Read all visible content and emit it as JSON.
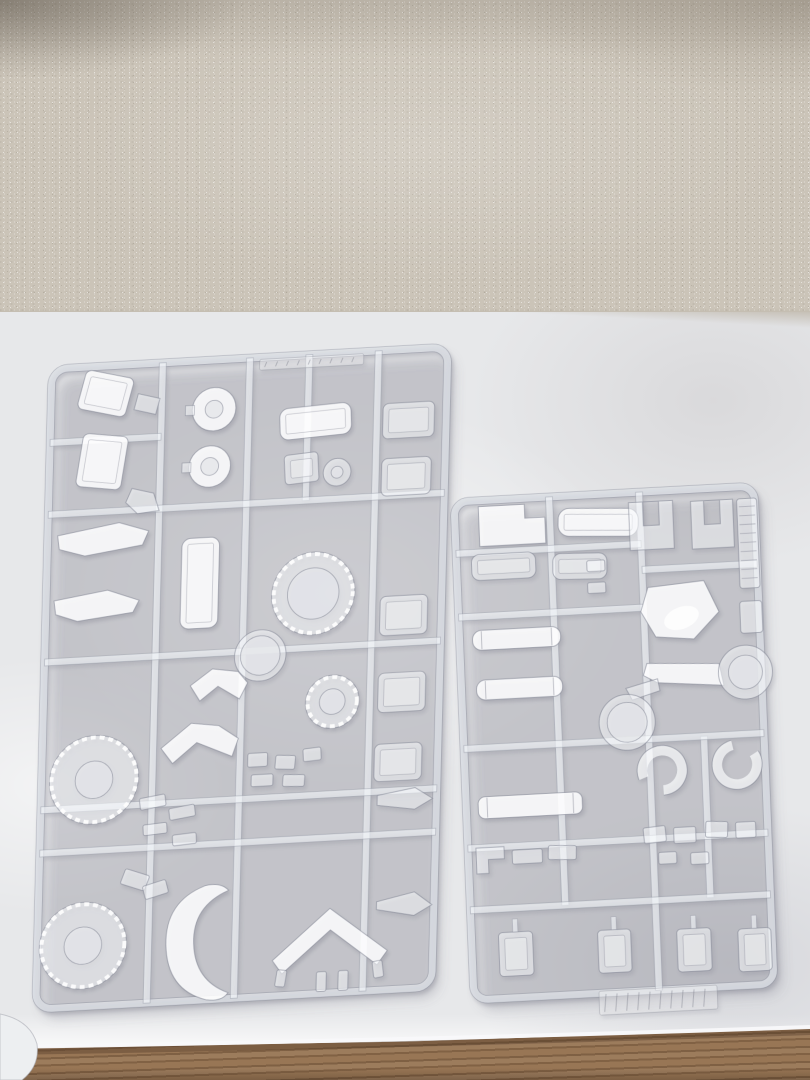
{
  "photo": {
    "width": 810,
    "height": 1080
  },
  "scene": {
    "colors": {
      "wallpaper": "#cbc4b8",
      "cloth": "#e7e8ea",
      "wood": "#916f4f",
      "plastic_fill": "rgba(252,253,255,0.55)",
      "plastic_bright": "rgba(255,255,255,0.88)",
      "plastic_outline": "rgba(128,131,146,0.55)",
      "rail_fill": "rgba(246,248,251,0.62)",
      "hole_fill": "rgba(229,230,234,0.8)"
    },
    "objects": [
      "wallpaper",
      "cloth-covered-table",
      "clear-sprue-left",
      "clear-sprue-right",
      "wood-table-edge",
      "cloth-fold"
    ]
  },
  "sprues": {
    "left": {
      "name": "clear-sprue-left",
      "matrix": [
        0.99,
        -0.055,
        -0.025,
        0.985,
        52,
        369
      ],
      "frame": [
        0,
        0,
        400,
        650,
        16
      ],
      "rails": {
        "v": [
          [
            112,
            0,
            650
          ],
          [
            200,
            0,
            650
          ],
          [
            330,
            0,
            650
          ],
          [
            260,
            0,
            148
          ]
        ],
        "h": [
          [
            148,
            0,
            400
          ],
          [
            298,
            0,
            400
          ],
          [
            448,
            0,
            400
          ],
          [
            492,
            0,
            400
          ],
          [
            75,
            0,
            112
          ]
        ]
      },
      "parts": [
        {
          "n": "armor-box",
          "t": "rect",
          "x": 30,
          "y": 8,
          "w": 50,
          "h": 40,
          "rx": 6,
          "rot": 14,
          "inner": 1,
          "bright": 1
        },
        {
          "n": "armor-box",
          "t": "rect",
          "x": 30,
          "y": 70,
          "w": 46,
          "h": 54,
          "rx": 6,
          "rot": 8,
          "inner": 1,
          "bright": 1
        },
        {
          "n": "small-wedge",
          "t": "poly",
          "pts": "88,30 110,36 106,52 84,46"
        },
        {
          "n": "small-foot",
          "t": "poly",
          "pts": "84,126 106,132 112,150 90,152 78,140"
        },
        {
          "n": "rimmed-disc",
          "t": "disc",
          "cx": 165,
          "cy": 50,
          "ro": 22,
          "ri": 9
        },
        {
          "n": "rimmed-disc",
          "t": "disc",
          "cx": 162,
          "cy": 108,
          "ro": 21,
          "ri": 9
        },
        {
          "n": "cockpit-block",
          "t": "rect",
          "x": 232,
          "y": 52,
          "w": 72,
          "h": 32,
          "rx": 9,
          "rot": -3,
          "inner": 1,
          "bright": 1
        },
        {
          "n": "bracket",
          "t": "rect",
          "x": 238,
          "y": 100,
          "w": 34,
          "h": 30,
          "rx": 4,
          "rot": -4,
          "inner": 1
        },
        {
          "n": "washer",
          "t": "ring",
          "cx": 291,
          "cy": 121,
          "ro": 14,
          "ri": 6
        },
        {
          "n": "panel",
          "t": "rect",
          "x": 336,
          "y": 54,
          "w": 52,
          "h": 36,
          "rx": 6,
          "inner": 1
        },
        {
          "n": "panel",
          "t": "rect",
          "x": 336,
          "y": 110,
          "w": 50,
          "h": 38,
          "rx": 6,
          "inner": 1
        },
        {
          "n": "panel",
          "t": "rect",
          "x": 338,
          "y": 250,
          "w": 48,
          "h": 40,
          "rx": 6,
          "inner": 1
        },
        {
          "n": "panel",
          "t": "rect",
          "x": 338,
          "y": 328,
          "w": 48,
          "h": 40,
          "rx": 6,
          "inner": 1
        },
        {
          "n": "panel",
          "t": "rect",
          "x": 336,
          "y": 400,
          "w": 48,
          "h": 38,
          "rx": 6,
          "inner": 1
        },
        {
          "n": "tray",
          "t": "rect",
          "x": 136,
          "y": 180,
          "w": 38,
          "h": 92,
          "rx": 9,
          "inner": 1,
          "bright": 1
        },
        {
          "n": "blade",
          "t": "poly",
          "pts": "10,170 72,160 102,170 96,184 38,192 12,184",
          "bright": 1
        },
        {
          "n": "blade",
          "t": "poly",
          "pts": "8,236 62,228 94,240 88,252 32,258 10,250",
          "bright": 1
        },
        {
          "n": "toothed-ring",
          "t": "ring",
          "cx": 270,
          "cy": 243,
          "ro": 42,
          "ri": 26,
          "teeth": 1
        },
        {
          "n": "ring",
          "t": "ring",
          "cx": 218,
          "cy": 303,
          "ro": 26,
          "ri": 20
        },
        {
          "n": "toothed-ring",
          "t": "ring",
          "cx": 292,
          "cy": 354,
          "ro": 27,
          "ri": 13,
          "teeth": 1
        },
        {
          "n": "curved-armor",
          "t": "poly",
          "pts": "148,330 170,314 196,318 206,330 198,346 176,332 158,346",
          "bright": 1
        },
        {
          "n": "curved-armor",
          "t": "poly",
          "pts": "120,392 150,368 178,372 198,386 192,404 156,388 132,408",
          "bright": 1
        },
        {
          "n": "toothed-donut",
          "t": "ring",
          "cx": 53,
          "cy": 420,
          "ro": 45,
          "ri": 19,
          "teeth": 1
        },
        {
          "n": "joint-bit",
          "t": "rect",
          "x": 100,
          "y": 440,
          "w": 26,
          "h": 12,
          "rot": -8
        },
        {
          "n": "joint-bit",
          "t": "rect",
          "x": 130,
          "y": 452,
          "w": 26,
          "h": 12,
          "rot": -8
        },
        {
          "n": "joint-bit",
          "t": "rect",
          "x": 104,
          "y": 468,
          "w": 24,
          "h": 11,
          "rot": -4
        },
        {
          "n": "joint-bit",
          "t": "rect",
          "x": 134,
          "y": 480,
          "w": 24,
          "h": 11,
          "rot": -4
        },
        {
          "n": "bracket-bit",
          "t": "rect",
          "x": 208,
          "y": 402,
          "w": 20,
          "h": 14
        },
        {
          "n": "bracket-bit",
          "t": "rect",
          "x": 236,
          "y": 406,
          "w": 20,
          "h": 14,
          "rot": 4
        },
        {
          "n": "bracket-bit",
          "t": "rect",
          "x": 264,
          "y": 400,
          "w": 18,
          "h": 13,
          "rot": -4
        },
        {
          "n": "bracket-bit",
          "t": "rect",
          "x": 212,
          "y": 424,
          "w": 22,
          "h": 12
        },
        {
          "n": "bracket-bit",
          "t": "rect",
          "x": 244,
          "y": 426,
          "w": 22,
          "h": 12,
          "rot": 3
        },
        {
          "n": "dart",
          "t": "poly",
          "pts": "340,452 378,446 396,458 378,468 340,462"
        },
        {
          "n": "dart",
          "t": "poly",
          "pts": "342,560 380,552 398,566 380,576 342,568"
        },
        {
          "n": "toothed-donut",
          "t": "ring",
          "cx": 46,
          "cy": 588,
          "ro": 44,
          "ri": 19,
          "teeth": 1
        },
        {
          "n": "joint-cluster",
          "t": "rect",
          "x": 84,
          "y": 516,
          "w": 26,
          "h": 16,
          "rot": 20
        },
        {
          "n": "joint-cluster",
          "t": "rect",
          "x": 106,
          "y": 528,
          "w": 24,
          "h": 14,
          "rot": -15
        },
        {
          "n": "shell",
          "t": "path",
          "d": "M168,534 Q128,548 130,592 Q132,638 172,650 Q188,653 194,644 Q160,630 158,592 Q156,554 192,540 Q184,531 168,534 Z",
          "bright": 1
        },
        {
          "n": "v-fin",
          "t": "poly",
          "pts": "295,564 354,610 344,624 296,586 248,628 238,614",
          "bright": 1
        },
        {
          "n": "v-fin-tip",
          "t": "rect",
          "x": 242,
          "y": 624,
          "w": 10,
          "h": 17,
          "rot": 8
        },
        {
          "n": "v-fin-tip",
          "t": "rect",
          "x": 340,
          "y": 620,
          "w": 10,
          "h": 17,
          "rot": -8
        },
        {
          "n": "stub-bit",
          "t": "rect",
          "x": 283,
          "y": 628,
          "w": 10,
          "h": 20
        },
        {
          "n": "stub-bit",
          "t": "rect",
          "x": 305,
          "y": 628,
          "w": 10,
          "h": 20
        },
        {
          "n": "emboss-strip",
          "t": "emboss",
          "x": 210,
          "y": 2,
          "w": 105,
          "h": 11
        }
      ]
    },
    "right": {
      "name": "clear-sprue-right",
      "matrix": [
        1,
        -0.0533,
        0.04,
        0.996,
        454,
        502
      ],
      "frame": [
        0,
        0,
        300,
        500,
        14
      ],
      "rails": {
        "v": [
          [
            95,
            0,
            410
          ],
          [
            185,
            0,
            500
          ],
          [
            240,
            248,
            410
          ]
        ],
        "h": [
          [
            52,
            0,
            185
          ],
          [
            78,
            185,
            300
          ],
          [
            116,
            0,
            185
          ],
          [
            248,
            0,
            300
          ],
          [
            348,
            0,
            300
          ],
          [
            410,
            0,
            300
          ]
        ]
      },
      "parts": [
        {
          "n": "notched-panel",
          "t": "poly",
          "pts": "24,6 70,6 70,20 90,20 90,46 24,46",
          "bright": 1
        },
        {
          "n": "panel",
          "t": "rect",
          "x": 103,
          "y": 14,
          "w": 80,
          "h": 28,
          "rx": 11,
          "rot": 3,
          "inner": 1,
          "bright": 1
        },
        {
          "n": "panel",
          "t": "rect",
          "x": 15,
          "y": 54,
          "w": 64,
          "h": 26,
          "rx": 8,
          "inner": 1
        },
        {
          "n": "panel",
          "t": "rect",
          "x": 96,
          "y": 58,
          "w": 54,
          "h": 26,
          "rx": 8,
          "rot": 2,
          "inner": 1
        },
        {
          "n": "fork",
          "t": "path",
          "d": "M174,10 L218,10 L218,58 L174,58 Z M188,10 L188,34 L204,34 L204,10 Z"
        },
        {
          "n": "fork",
          "t": "path",
          "d": "M236,12 L278,12 L278,60 L236,60 Z M249,12 L249,36 L265,36 L265,12 Z"
        },
        {
          "n": "ribbed-strip",
          "t": "rect",
          "x": 282,
          "y": 12,
          "w": 20,
          "h": 90,
          "rx": 3,
          "ladder": 1
        },
        {
          "n": "small-panel",
          "t": "rect",
          "x": 281,
          "y": 115,
          "w": 22,
          "h": 32,
          "rx": 3
        },
        {
          "n": "bit",
          "t": "rect",
          "x": 130,
          "y": 66,
          "w": 18,
          "h": 11
        },
        {
          "n": "bit",
          "t": "rect",
          "x": 130,
          "y": 88,
          "w": 18,
          "h": 11
        },
        {
          "n": "canopy",
          "t": "poly",
          "pts": "190,96 246,92 260,124 234,150 196,146 182,120",
          "bright": 1,
          "gloss": 1
        },
        {
          "n": "cylinder",
          "t": "rect",
          "x": 13,
          "y": 130,
          "w": 88,
          "h": 20,
          "rx": 9,
          "cyl": 1,
          "bright": 1
        },
        {
          "n": "cylinder",
          "t": "rect",
          "x": 15,
          "y": 180,
          "w": 86,
          "h": 20,
          "rx": 9,
          "cyl": 1,
          "bright": 1
        },
        {
          "n": "arm",
          "t": "poly",
          "pts": "186,172 258,176 262,198 196,192 182,184",
          "bright": 1
        },
        {
          "n": "arm-ring",
          "t": "ring",
          "cx": 284,
          "cy": 186,
          "ro": 27,
          "ri": 17
        },
        {
          "n": "arm-tail",
          "t": "poly",
          "pts": "164,196 196,188 198,200 170,208"
        },
        {
          "n": "ring",
          "t": "ring",
          "cx": 164,
          "cy": 230,
          "ro": 28,
          "ri": 20
        },
        {
          "n": "cuff",
          "t": "ring",
          "cx": 197,
          "cy": 280,
          "ro": 25,
          "ri": 15,
          "gap": 1,
          "rotg": 160
        },
        {
          "n": "cuff",
          "t": "ring",
          "cx": 272,
          "cy": 278,
          "ro": 25,
          "ri": 15,
          "gap": 1,
          "rotg": -30
        },
        {
          "n": "cylinder",
          "t": "rect",
          "x": 12,
          "y": 297,
          "w": 104,
          "h": 22,
          "rx": 7,
          "cyl": 1,
          "bright": 1
        },
        {
          "n": "l-bracket",
          "t": "poly",
          "pts": "8,348 36,348 36,360 20,360 20,374 8,374"
        },
        {
          "n": "bracket-bit",
          "t": "rect",
          "x": 44,
          "y": 352,
          "w": 30,
          "h": 14
        },
        {
          "n": "bracket-bit",
          "t": "rect",
          "x": 80,
          "y": 350,
          "w": 28,
          "h": 14,
          "rot": 3
        },
        {
          "n": "bracket-bit",
          "t": "rect",
          "x": 176,
          "y": 336,
          "w": 22,
          "h": 16,
          "rot": -4
        },
        {
          "n": "bracket-bit",
          "t": "rect",
          "x": 206,
          "y": 338,
          "w": 22,
          "h": 16
        },
        {
          "n": "bracket-bit",
          "t": "rect",
          "x": 238,
          "y": 334,
          "w": 22,
          "h": 16,
          "rot": 4
        },
        {
          "n": "bracket-bit",
          "t": "rect",
          "x": 268,
          "y": 336,
          "w": 20,
          "h": 16
        },
        {
          "n": "bracket-bit",
          "t": "rect",
          "x": 190,
          "y": 362,
          "w": 18,
          "h": 12
        },
        {
          "n": "bracket-bit",
          "t": "rect",
          "x": 222,
          "y": 364,
          "w": 18,
          "h": 12
        },
        {
          "n": "box-part",
          "t": "rect",
          "x": 27,
          "y": 434,
          "w": 34,
          "h": 44,
          "rx": 4,
          "inner": 1,
          "stem": 1
        },
        {
          "n": "box-part",
          "t": "rect",
          "x": 126,
          "y": 437,
          "w": 33,
          "h": 43,
          "rx": 4,
          "inner": 1,
          "stem": 1
        },
        {
          "n": "box-part",
          "t": "rect",
          "x": 205,
          "y": 440,
          "w": 34,
          "h": 43,
          "rx": 4,
          "inner": 1,
          "stem": 1
        },
        {
          "n": "box-part",
          "t": "rect",
          "x": 266,
          "y": 443,
          "w": 33,
          "h": 43,
          "rx": 4,
          "inner": 1,
          "stem": 1
        },
        {
          "n": "molded-tag",
          "t": "emboss",
          "x": 125,
          "y": 498,
          "w": 118,
          "h": 24
        }
      ]
    }
  }
}
